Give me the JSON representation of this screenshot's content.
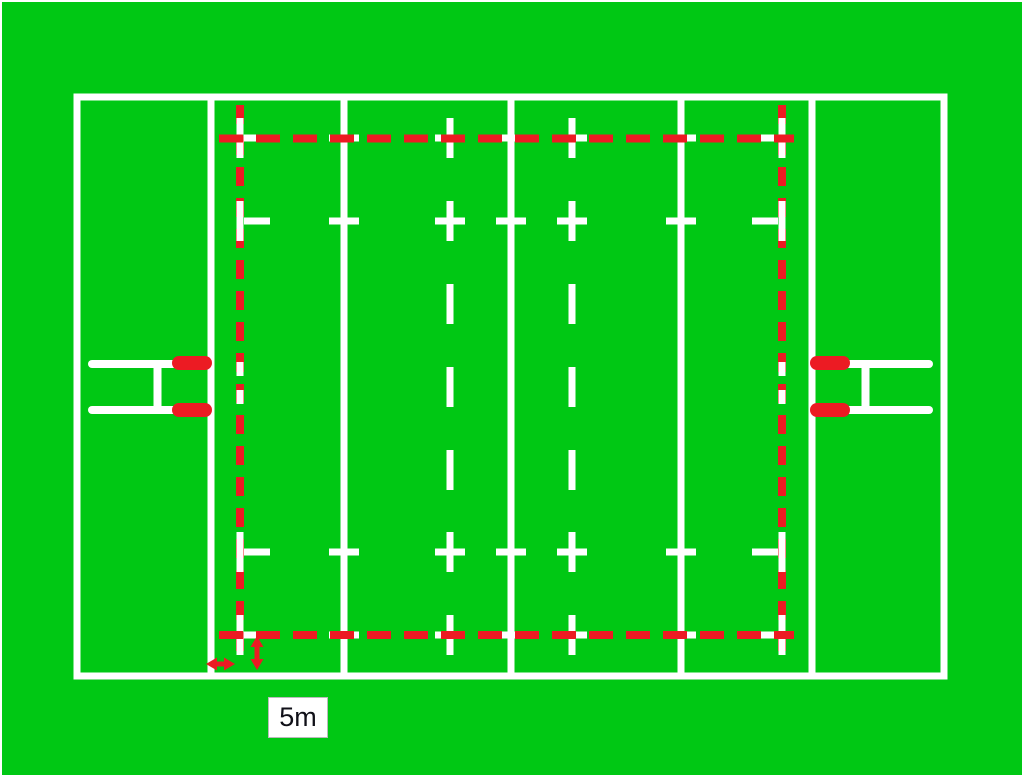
{
  "title": "Rugby pitch plan with five-metre lines highlighted",
  "measurement_label": {
    "text": "5m"
  },
  "colors": {
    "field_green": "#00C814",
    "line_white": "#FFFFFF",
    "highlight_red": "#EC1B23",
    "label_text": "#101018",
    "label_background": "#FFFFFF",
    "label_border": "#BBBBBB"
  },
  "markings": {
    "perimeter": "pitch-perimeter",
    "vertical_lines": [
      "goal-line-left",
      "five-metre-dashed-line-left",
      "22m-line-left",
      "10m-dashed-line-left",
      "halfway-line",
      "10m-dashed-line-right",
      "22m-line-right",
      "five-metre-dashed-line-right",
      "goal-line-right"
    ],
    "dash_mark_rows": [
      "5m-from-top-touchline",
      "15m-from-top-touchline",
      "15m-from-bottom-touchline",
      "5m-from-bottom-touchline"
    ],
    "goalposts": [
      "goalposts-left",
      "goalposts-right"
    ],
    "arrows": [
      "five-metre-horizontal-arrow",
      "five-metre-vertical-arrow"
    ]
  }
}
